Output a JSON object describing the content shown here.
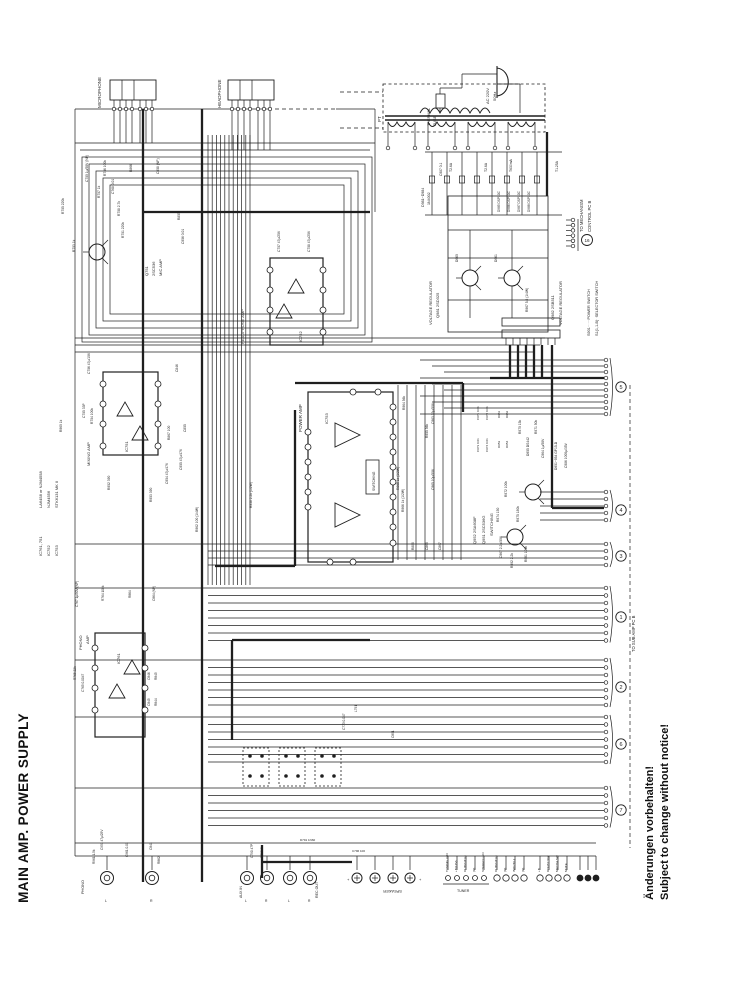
{
  "title": "MAIN AMP. POWER SUPPLY",
  "notice": {
    "german": "Änderungen vorbehalten!",
    "english": "Subject to change without notice!"
  },
  "colors": {
    "ink": "#1f1f1f",
    "paper": "#ffffff"
  },
  "connector_numbers": [
    {
      "x": 621,
      "y": 387,
      "label": "5"
    },
    {
      "x": 621,
      "y": 510,
      "label": "4"
    },
    {
      "x": 621,
      "y": 556,
      "label": "3"
    },
    {
      "x": 621,
      "y": 617,
      "label": "1"
    },
    {
      "x": 621,
      "y": 687,
      "label": "2"
    },
    {
      "x": 621,
      "y": 744,
      "label": "6"
    },
    {
      "x": 621,
      "y": 810,
      "label": "7"
    },
    {
      "x": 587,
      "y": 240,
      "label": "16"
    }
  ],
  "labels": [
    [
      "MICROPHONE",
      101,
      108,
      -90,
      4.5
    ],
    [
      "HEADPHONE",
      221,
      108,
      -90,
      4.5
    ],
    [
      "PT",
      381,
      122,
      -90,
      4.5
    ],
    [
      "THERMAL",
      430,
      126,
      -90,
      3.8
    ],
    [
      "FUSE",
      436,
      126,
      -90,
      3.8
    ],
    [
      "AC 220V",
      489,
      104,
      -90,
      4
    ],
    [
      "50Hz",
      496,
      101,
      -90,
      4
    ],
    [
      "D981~D984",
      424,
      207,
      -90,
      3.6
    ],
    [
      "1N4002",
      430,
      205,
      -90,
      3.6
    ],
    [
      "C987 0.1",
      442,
      176,
      -90,
      3.3
    ],
    [
      "T2.6A",
      452,
      172,
      -90,
      3.4
    ],
    [
      "T2.6A",
      487,
      172,
      -90,
      3.4
    ],
    [
      "T630mA",
      512,
      172,
      -90,
      3.4
    ],
    [
      "T1.25A",
      558,
      172,
      -90,
      3.4
    ],
    [
      "D985 DSP10C",
      500,
      212,
      -90,
      3.2
    ],
    [
      "D986 DSP10C",
      510,
      212,
      -90,
      3.2
    ],
    [
      "D987 DSP10C",
      520,
      212,
      -90,
      3.2
    ],
    [
      "D988 DSP10C",
      530,
      212,
      -90,
      3.2
    ],
    [
      "TO MECHANISM",
      583,
      232,
      -90,
      4.2
    ],
    [
      "CONTROL PC B",
      591,
      232,
      -90,
      4.2
    ],
    [
      "S901······POWER SWITCH",
      590,
      336,
      -90,
      3.8
    ],
    [
      "S1(1,1-B)··SELECTOR SWITCH",
      598,
      336,
      -90,
      3.8
    ],
    [
      "VOLTAGE REGULATOR",
      432,
      325,
      -90,
      4
    ],
    [
      "Q981 2SD325",
      439,
      318,
      -90,
      4
    ],
    [
      "Q982 2SB511",
      554,
      320,
      -90,
      4
    ],
    [
      "VOLTAGE REGULATOR",
      562,
      325,
      -90,
      4
    ],
    [
      "D960",
      458,
      262,
      -90,
      3.3
    ],
    [
      "D961",
      497,
      262,
      -90,
      3.3
    ],
    [
      "R967 5.6 (1/4W)",
      528,
      312,
      -90,
      3.3
    ],
    [
      "Q751",
      148,
      276,
      -90,
      4
    ],
    [
      "2SC536",
      155,
      276,
      -90,
      4
    ],
    [
      "MIC AMP",
      162,
      276,
      -90,
      4
    ],
    [
      "C750 1µ/50V (NP)",
      88,
      182,
      -90,
      3.3
    ],
    [
      "R756 100k",
      106,
      176,
      -90,
      3.3
    ],
    [
      "R866",
      132,
      172,
      -90,
      3.3
    ],
    [
      "C858 (NP)",
      159,
      174,
      -90,
      3.3
    ],
    [
      "R755 220k",
      64,
      214,
      -90,
      3.3
    ],
    [
      "R757 1k",
      100,
      198,
      -90,
      3.3
    ],
    [
      "C768 0.01",
      114,
      194,
      -90,
      3.3
    ],
    [
      "R758 2.7k",
      120,
      216,
      -90,
      3.3
    ],
    [
      "R751 220k",
      124,
      238,
      -90,
      3.3
    ],
    [
      "R855",
      180,
      220,
      -90,
      3.3
    ],
    [
      "C956 0.01",
      184,
      244,
      -90,
      3.3
    ],
    [
      "R753 1k",
      75,
      252,
      -90,
      3.3
    ],
    [
      "HEADPHONE AMP",
      244,
      344,
      -90,
      4
    ],
    [
      "IC752",
      302,
      342,
      -90,
      4
    ],
    [
      "C757 47µ/25V",
      280,
      252,
      -90,
      3.3
    ],
    [
      "C758 47µ/25V",
      310,
      252,
      -90,
      3.3
    ],
    [
      "MIXING AMP",
      90,
      466,
      -90,
      4
    ],
    [
      "IC751",
      128,
      452,
      -90,
      4
    ],
    [
      "C756 47µ/10V",
      90,
      374,
      -90,
      3.3
    ],
    [
      "C755 33P",
      85,
      418,
      -90,
      3.3
    ],
    [
      "R754 100k",
      93,
      424,
      -90,
      3.3
    ],
    [
      "C846",
      178,
      372,
      -90,
      3.3
    ],
    [
      "R867 100",
      170,
      440,
      -90,
      3.3
    ],
    [
      "C855",
      186,
      432,
      -90,
      3.3
    ],
    [
      "R952 390",
      110,
      490,
      -90,
      3.3
    ],
    [
      "R953 390",
      152,
      502,
      -90,
      3.3
    ],
    [
      "C954 47µ/47V",
      168,
      484,
      -90,
      3.3
    ],
    [
      "C955 47µ/47V",
      182,
      470,
      -90,
      3.3
    ],
    [
      "R960 1k",
      62,
      432,
      -90,
      3.3
    ],
    [
      "R962 100 (1/4W)",
      198,
      532,
      -90,
      3.3
    ],
    [
      "R958 2.2k (1/2W)",
      252,
      508,
      -90,
      3.3
    ],
    [
      "POWER AMP",
      302,
      432,
      -90,
      4.5
    ],
    [
      "IC753",
      328,
      424,
      -90,
      4
    ],
    [
      "SWITCHING",
      375,
      491,
      -90,
      3.4
    ],
    [
      "R964 56k",
      405,
      410,
      -90,
      3.3
    ],
    [
      "C963 33µ/50V",
      434,
      424,
      -90,
      3.3
    ],
    [
      "R955 56k",
      428,
      438,
      -90,
      3.3
    ],
    [
      "R965 1k (1/2W)",
      399,
      490,
      -90,
      3.3
    ],
    [
      "R966 1k (1/2W)",
      404,
      512,
      -90,
      3.3
    ],
    [
      "C965 10µ/50V",
      434,
      490,
      -90,
      3.3
    ],
    [
      "R886",
      414,
      550,
      -90,
      3.3
    ],
    [
      "C868",
      428,
      550,
      -90,
      3.3
    ],
    [
      "C867",
      441,
      550,
      -90,
      3.3
    ],
    [
      "Q952 2SA608F",
      476,
      544,
      -90,
      4
    ],
    [
      "Q951 2SC536G",
      485,
      544,
      -90,
      4
    ],
    [
      "SWITCHING",
      493,
      536,
      -90,
      4
    ],
    [
      "C971 0.01",
      479,
      420,
      -90,
      3
    ],
    [
      "C972 0.01",
      488,
      420,
      -90,
      3
    ],
    [
      "C973 0.01",
      479,
      452,
      -90,
      3
    ],
    [
      "C974 0.01",
      488,
      452,
      -90,
      3
    ],
    [
      "D951",
      500,
      418,
      -90,
      3
    ],
    [
      "D952",
      508,
      418,
      -90,
      3
    ],
    [
      "D953",
      500,
      448,
      -90,
      3
    ],
    [
      "D954",
      508,
      448,
      -90,
      3
    ],
    [
      "R970 15k",
      521,
      434,
      -90,
      3.3
    ],
    [
      "R971 50k",
      537,
      434,
      -90,
      3.3
    ],
    [
      "D955 DS442",
      529,
      456,
      -90,
      3.3
    ],
    [
      "C964 1µ/50V",
      544,
      458,
      -90,
      3.3
    ],
    [
      "D951~954 GP15-D",
      557,
      470,
      -90,
      3.3
    ],
    [
      "R972 100k",
      507,
      497,
      -90,
      3.3
    ],
    [
      "R974 150",
      499,
      522,
      -90,
      3.3
    ],
    [
      "R975 180k",
      519,
      522,
      -90,
      3.3
    ],
    [
      "C967 2.2µ/50V",
      502,
      558,
      -90,
      3.3
    ],
    [
      "R992 2.2k",
      513,
      568,
      -90,
      3.3
    ],
    [
      "R991 100k",
      527,
      562,
      -90,
      3.3
    ],
    [
      "C986 1000µ/35V",
      567,
      468,
      -90,
      3.3
    ],
    [
      "PHONO",
      82,
      650,
      -90,
      4
    ],
    [
      "AMP",
      89,
      644,
      -90,
      4
    ],
    [
      "IC761",
      120,
      664,
      -90,
      4
    ],
    [
      "C767 1µ/50V (NP)",
      78,
      607,
      -90,
      3.2
    ],
    [
      "R764 100k",
      104,
      601,
      -90,
      3.2
    ],
    [
      "R864",
      131,
      598,
      -90,
      3.2
    ],
    [
      "C864 (NP)",
      155,
      601,
      -90,
      3.2
    ],
    [
      "R765 22k",
      76,
      680,
      -90,
      3.2
    ],
    [
      "C765 0.0047",
      84,
      692,
      -90,
      3.2
    ],
    [
      "C846",
      150,
      680,
      -90,
      3.2
    ],
    [
      "R845",
      157,
      680,
      -90,
      3.2
    ],
    [
      "C845",
      150,
      706,
      -90,
      3.2
    ],
    [
      "R844",
      157,
      706,
      -90,
      3.2
    ],
    [
      "C773 0.047",
      345,
      730,
      -90,
      3.2
    ],
    [
      "L791",
      357,
      712,
      -90,
      3.2
    ],
    [
      "C891",
      394,
      738,
      -90,
      3.2
    ],
    [
      "IC761, 751",
      42,
      556,
      -90,
      4
    ],
    [
      "IC752",
      50,
      556,
      -90,
      4
    ],
    [
      "IC753",
      58,
      556,
      -90,
      4
    ],
    [
      "LA6458 or NJM4558",
      42,
      508,
      -90,
      4
    ],
    [
      "NJM4556",
      50,
      508,
      -90,
      4
    ],
    [
      "STK6131 MK II",
      58,
      508,
      -90,
      4
    ],
    [
      "TO SUB AMP  PC B",
      635,
      652,
      -90,
      4.2
    ],
    [
      "PHONO",
      84,
      894,
      -90,
      3.8
    ],
    [
      "L",
      105,
      902,
      0,
      3.5
    ],
    [
      "R",
      150,
      902,
      0,
      3.5
    ],
    [
      "AUX IN",
      242,
      898,
      -90,
      3.6
    ],
    [
      "L",
      245,
      902,
      0,
      3.3
    ],
    [
      "R",
      265,
      902,
      0,
      3.3
    ],
    [
      "REC OUT",
      318,
      898,
      -90,
      3.6
    ],
    [
      "L",
      288,
      902,
      0,
      3.3
    ],
    [
      "R",
      308,
      902,
      0,
      3.3
    ],
    [
      "SPEAKER",
      402,
      890,
      180,
      4
    ],
    [
      "+",
      347,
      881,
      0,
      4
    ],
    [
      "+",
      419,
      881,
      0,
      4
    ],
    [
      "TUNING LED",
      448,
      872,
      -90,
      3.1
    ],
    [
      "+B(12V)",
      457,
      872,
      -90,
      3.1
    ],
    [
      "OUTPUT(L)",
      466,
      872,
      -90,
      3.1
    ],
    [
      "(R)",
      475,
      872,
      -90,
      3.1
    ],
    [
      "STEREO LED",
      484,
      872,
      -90,
      3.1
    ],
    [
      "TUNER",
      457,
      892,
      0,
      3.6
    ],
    [
      "OUTPUT(L)",
      497,
      872,
      -90,
      3.1
    ],
    [
      "(R)",
      506,
      872,
      -90,
      3.1
    ],
    [
      "INPUT(L)",
      515,
      872,
      -90,
      3.1
    ],
    [
      "(R)",
      524,
      872,
      -90,
      3.1
    ],
    [
      "+B",
      540,
      872,
      -90,
      3.1
    ],
    [
      "DOLBY SW",
      549,
      872,
      -90,
      3.1
    ],
    [
      "MECHA SW",
      558,
      872,
      -90,
      3.1
    ],
    [
      "MUTE",
      567,
      872,
      -90,
      3.1
    ],
    [
      "R961 1.5k",
      95,
      864,
      -90,
      3.2
    ],
    [
      "C951 47µ/25V",
      103,
      850,
      -90,
      3.2
    ],
    [
      "C961 0.01",
      128,
      857,
      -90,
      3.2
    ],
    [
      "C841",
      152,
      850,
      -90,
      3.2
    ],
    [
      "R862",
      160,
      864,
      -90,
      3.2
    ],
    [
      "C790 47P",
      253,
      858,
      -90,
      3.2
    ],
    [
      "R790 1k",
      263,
      858,
      -90,
      3.2
    ],
    [
      "D791 1N60",
      300,
      841,
      0,
      3
    ],
    [
      "C796 100",
      352,
      852,
      0,
      3
    ]
  ]
}
